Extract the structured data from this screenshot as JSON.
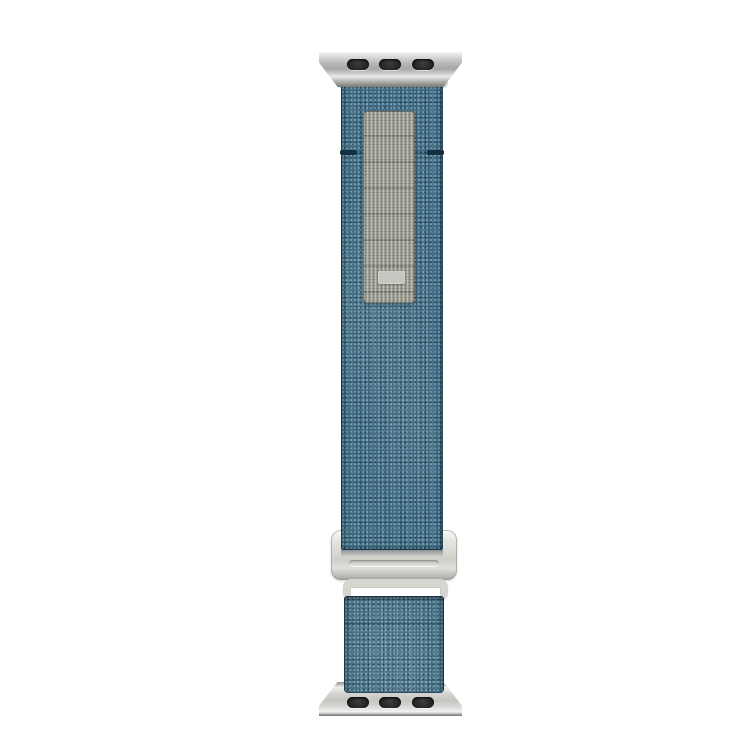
{
  "image": {
    "type": "product-photo",
    "subject": "Denim-blue woven smartwatch band with silver lug adapters, gray hook-and-loop panel and silver G-hook buckle on white background",
    "background_color": "#ffffff",
    "colors": {
      "fabric_base": "#45718a",
      "fabric_dark_speck": "#1d4458",
      "fabric_light_speck": "#9fc0cb",
      "loop_panel": "#a5a59b",
      "loop_tab": "#c6c6c0",
      "metal_light": "#e0e0de",
      "metal_mid": "#c4c4c0",
      "metal_dark": "#a2a29c",
      "slot_color": "#242424"
    },
    "parts": [
      {
        "name": "top-lug-adapter",
        "description": "silver watch lug connector with three dark slots"
      },
      {
        "name": "upper-strap",
        "description": "blue woven fabric strap, folded over lug with stitched seam"
      },
      {
        "name": "hook-loop-panel",
        "description": "gray woven loop panel with small light pull tab"
      },
      {
        "name": "g-hook-buckle",
        "description": "silver metal buckle with keeper loop"
      },
      {
        "name": "lower-strap",
        "description": "short blue fabric strap segment below buckle"
      },
      {
        "name": "bottom-lug-adapter",
        "description": "silver watch lug connector with three dark slots"
      }
    ]
  }
}
